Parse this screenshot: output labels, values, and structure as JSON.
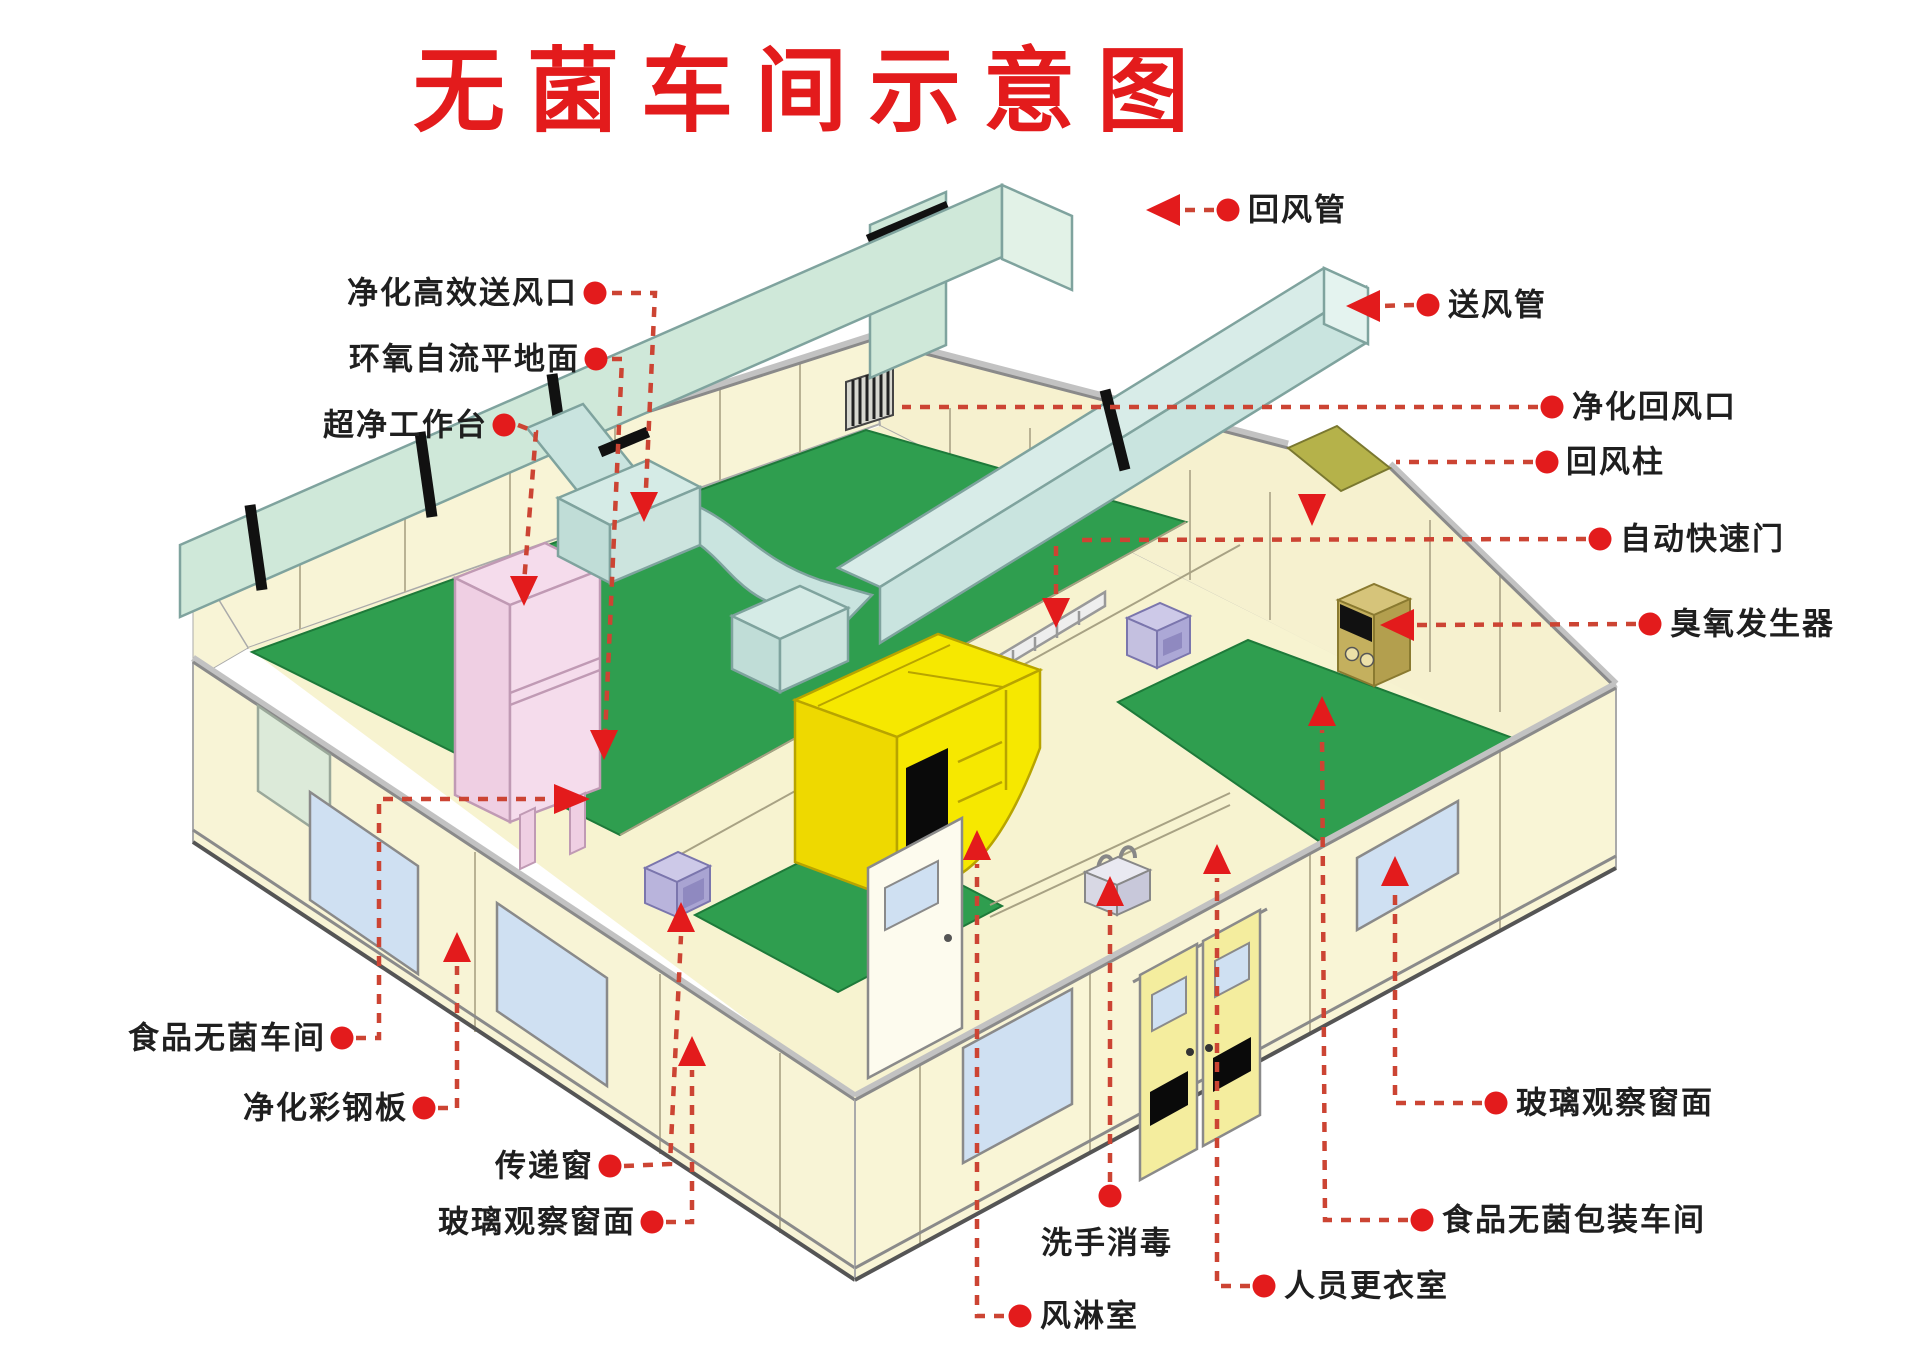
{
  "title": "无菌车间示意图",
  "labels": {
    "return_duct": "回风管",
    "supply_duct": "送风管",
    "purified_return_inlet": "净化回风口",
    "return_air_column": "回风柱",
    "automatic_rapid_door": "自动快速门",
    "ozone_generator": "臭氧发生器",
    "glass_observation_window_right": "玻璃观察窗面",
    "food_sterile_packaging_workshop": "食品无菌包装车间",
    "staff_changing_room": "人员更衣室",
    "air_shower_room": "风淋室",
    "hand_washing_disinfection": "洗手消毒",
    "glass_observation_window_left": "玻璃观察窗面",
    "pass_through_window": "传递窗",
    "purification_color_steel_plate": "净化彩钢板",
    "food_sterile_workshop": "食品无菌车间",
    "ultra_clean_workbench": "超净工作台",
    "epoxy_self_leveling_floor": "环氧自流平地面",
    "hepa_supply_air_outlet": "净化高效送风口"
  },
  "colors": {
    "title_red": "#e31b1c",
    "leader_red": "#cc4433",
    "duct_mint": "#cfe8d9",
    "supply_mint": "#c9e4df",
    "wall_cream": "#f8f4d6",
    "floor_green": "#2f9e4f",
    "air_shower_yellow": "#f6e800",
    "bench_pink": "#f5dcec",
    "window_blue": "#cfe0f2",
    "ozone_tan": "#c4b05e",
    "olive_panel": "#b5b24a"
  }
}
